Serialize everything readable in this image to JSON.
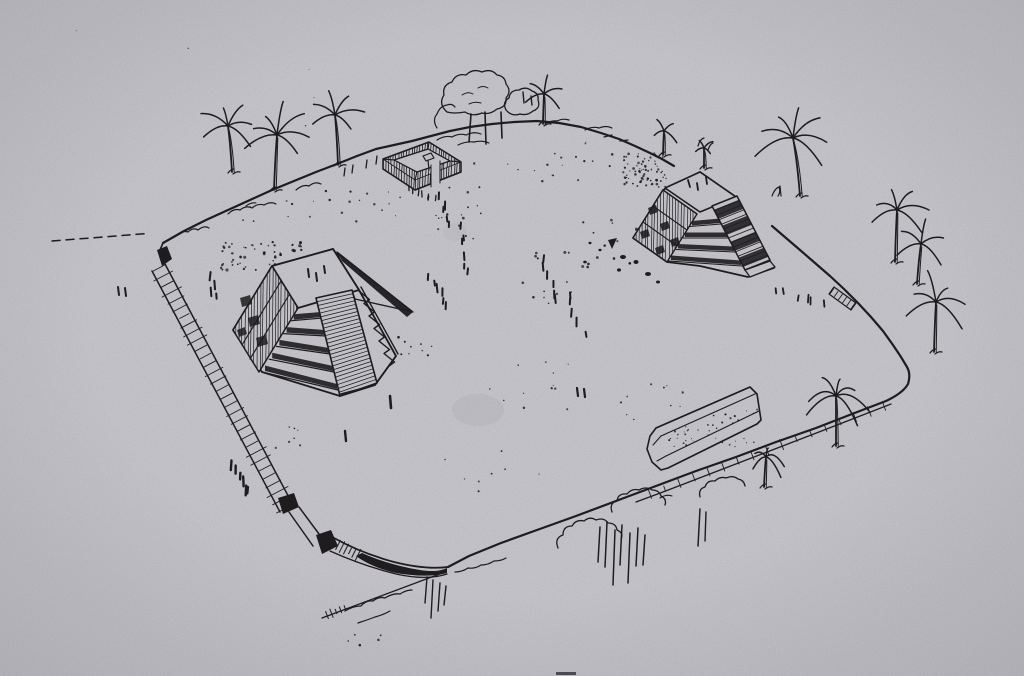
{
  "artwork": {
    "medium": "black ink line drawing photographed on gray paper",
    "subject": "Aerial reconstruction drawing of a fortified plateau site with two stepped pyramids, a small rectangular court enclosure, a long low platform mound, palm trees and scrub vegetation on the slopes",
    "colors": {
      "paper": "#d3d2d8",
      "ink": "#211f22",
      "stain": "#8e8b96",
      "vignette": "#2c2a38"
    },
    "features": [
      {
        "name": "plateau-rim",
        "label": "Irregular rounded plateau edge line"
      },
      {
        "name": "west-embankment",
        "label": "Hatched embankment wall along the west edge"
      },
      {
        "name": "left-pyramid",
        "label": "Large stepped pyramid with central staircase and cast shadow"
      },
      {
        "name": "right-pyramid",
        "label": "Smaller stepped pyramid with staircase and rubble at its base"
      },
      {
        "name": "courtyard-structure",
        "label": "Small rectangular walled court with doorway and central altar"
      },
      {
        "name": "long-platform",
        "label": "Long low platform mound near the south rim"
      },
      {
        "name": "palm-trees",
        "label": "Scattered palm trees around the rim",
        "count": 12
      },
      {
        "name": "tree-cluster",
        "label": "Broadleaf tree clump on the north rim"
      },
      {
        "name": "slope-vegetation",
        "label": "Scrub, bushes and grass on the south slope"
      },
      {
        "name": "stipple-marks",
        "label": "Stippled ground texture, tick trails and rubble"
      }
    ]
  }
}
